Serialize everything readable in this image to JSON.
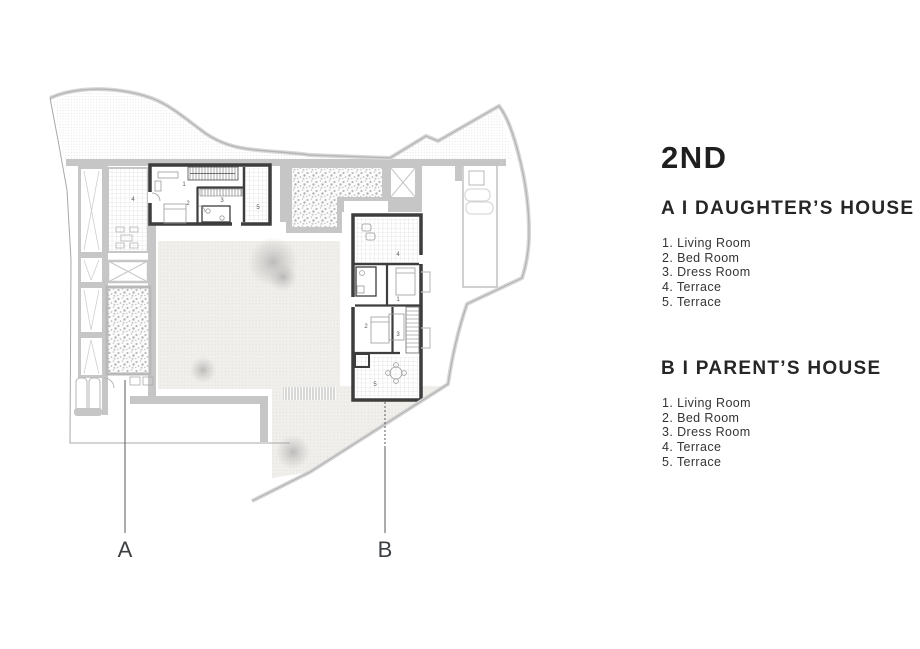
{
  "title": "2ND",
  "sections": [
    {
      "id": "A",
      "heading": "A I DAUGHTER’S HOUSE",
      "items": [
        "1. Living Room",
        "2. Bed Room",
        "3. Dress Room",
        "4. Terrace",
        "5. Terrace"
      ]
    },
    {
      "id": "B",
      "heading": "B I PARENT’S HOUSE",
      "items": [
        "1. Living Room",
        "2. Bed Room",
        "3. Dress Room",
        "4. Terrace",
        "5. Terrace"
      ]
    }
  ],
  "plan": {
    "markers": {
      "a": "A",
      "b": "B"
    },
    "unit_a_rooms": {
      "living": "1",
      "bed": "2",
      "dress": "3",
      "terrace4": "4",
      "terrace5": "5"
    },
    "unit_b_rooms": {
      "living": "1",
      "bed": "2",
      "dress": "3",
      "terrace4": "4",
      "terrace5": "5"
    },
    "colors": {
      "wall_dark": "#3d3d3d",
      "wall_light": "#c6c6c6",
      "boundary": "#bdbdbd",
      "text": "#2b2b2b"
    }
  }
}
